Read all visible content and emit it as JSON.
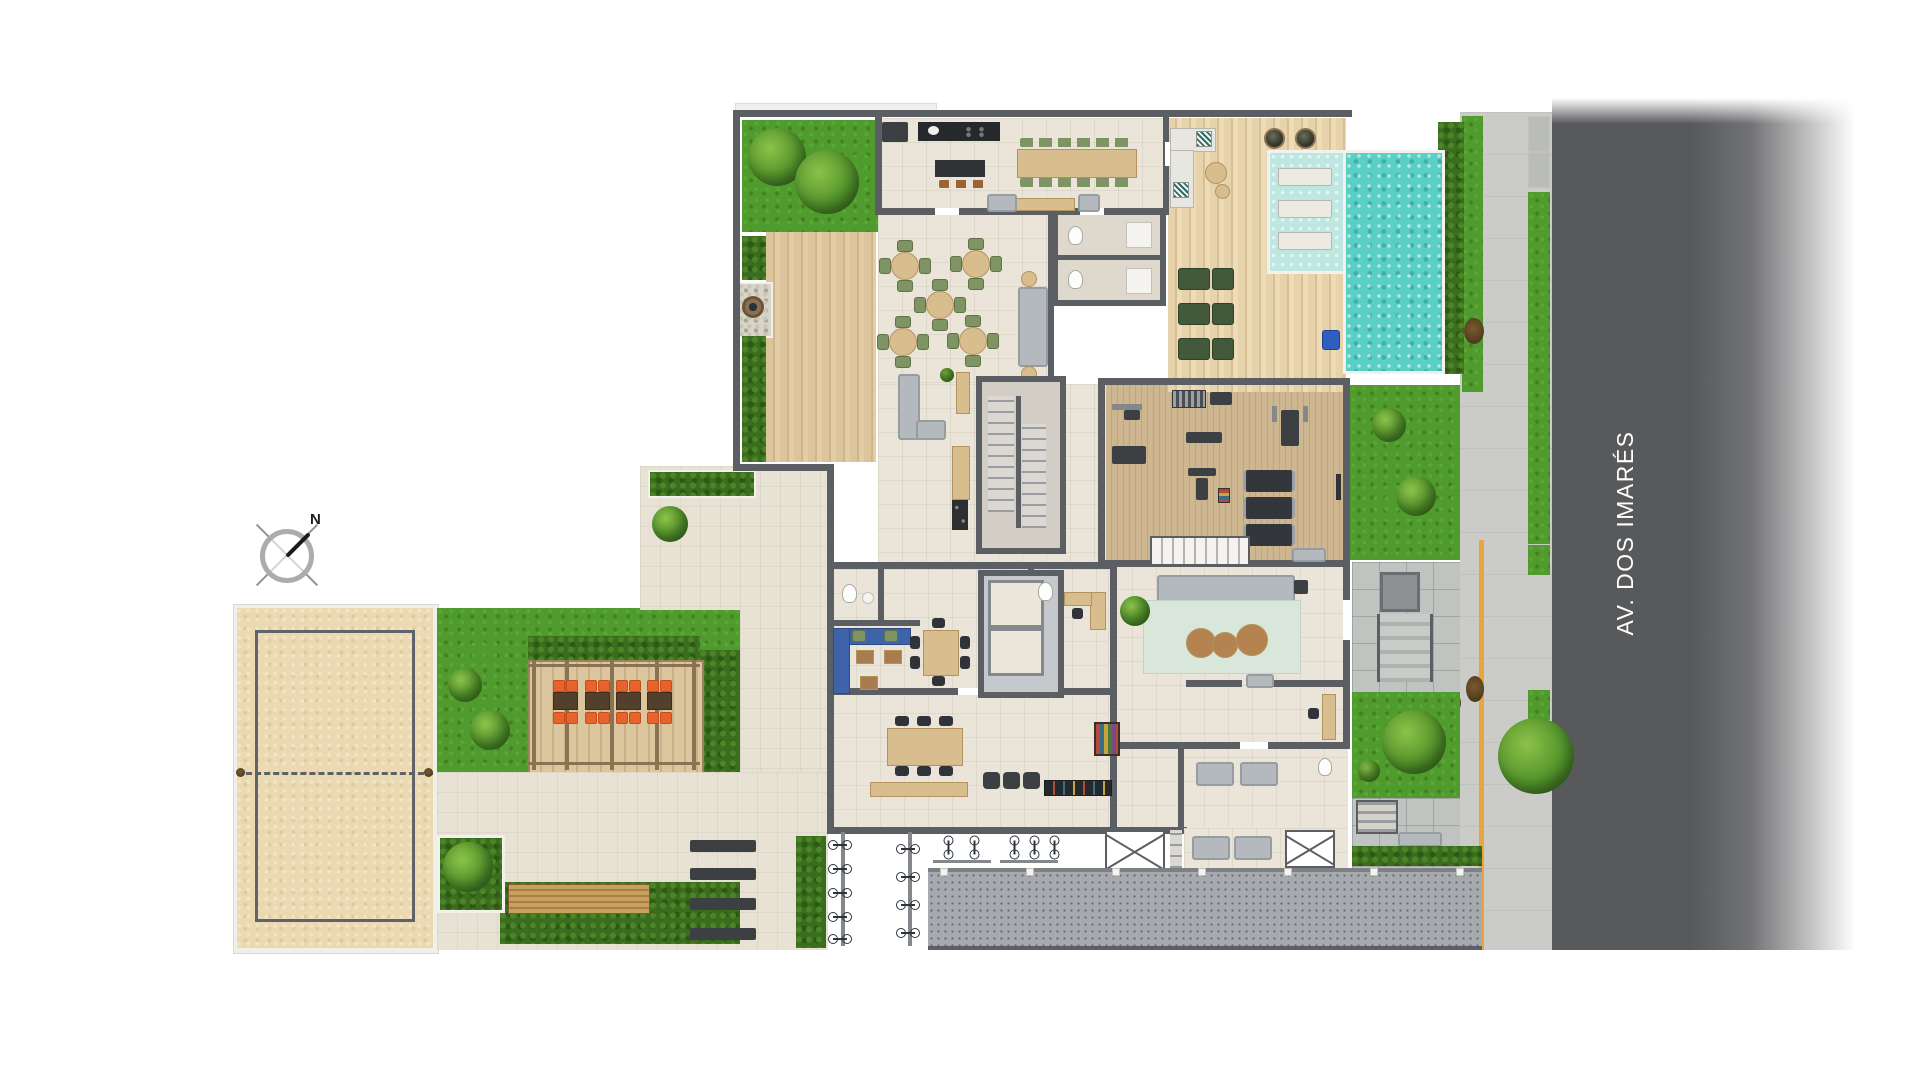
{
  "labels": {
    "street_name": "AV. DOS IMARÉS",
    "compass_north": "N"
  },
  "palette": {
    "background": "#ffffff",
    "asphalt": "#58595b",
    "sidewalk_concrete": "#cbccc7",
    "paver_gray": "#c0c4c1",
    "driveway_gray": "#a6aaae",
    "tactile_yellow": "#e9a43c",
    "wall_dark": "#5b5e62",
    "interior_tile": "#ebe5d9",
    "wood_deck": "#d9c096",
    "gym_wood": "#c8b188",
    "grass_green": "#4f9b2e",
    "hedge_green": "#3a6d1d",
    "pool_water": "#59cfc5",
    "wet_deck": "#bfe7e1",
    "sand_beige": "#ead9b2",
    "chair_green": "#7f9464",
    "chair_orange": "#e8632b",
    "sofa_gray": "#b3b9bc",
    "sofa_blue": "#3f63a8",
    "rug_mint": "#d9e7da",
    "accessible_pool_lift_blue": "#2f5fbe"
  }
}
